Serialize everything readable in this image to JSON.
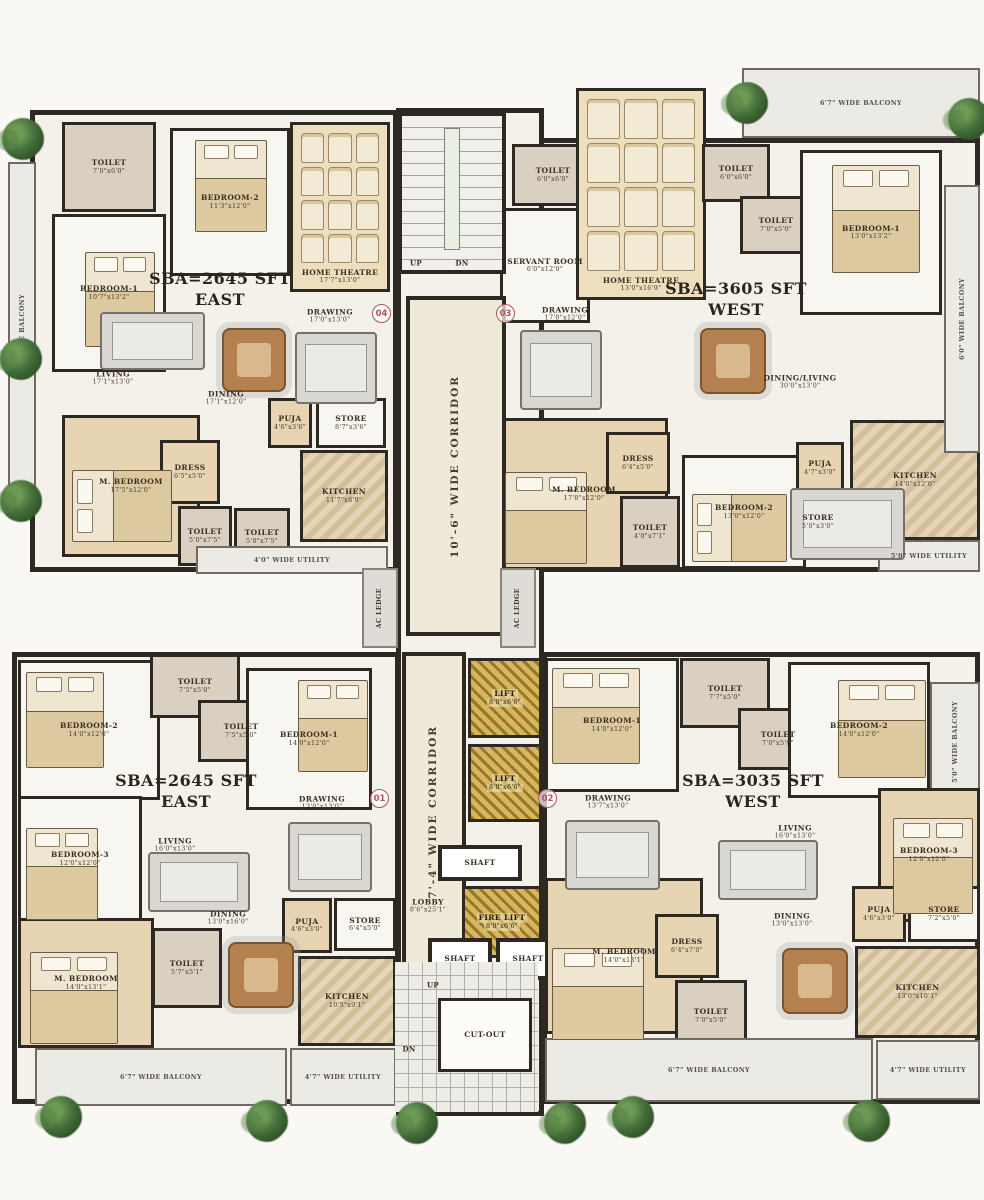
{
  "plan_title": "Residential tower typical floor plan with four units",
  "colors": {
    "wall": "#2e2823",
    "slab": "#f3f1ea",
    "tan_room": "#e6d4b2",
    "toilet": "#d9d0c2",
    "theatre": "#eddfbd",
    "corridor": "#efe9da",
    "lift_gold": "#c8a23c",
    "balcony": "#eceae5",
    "tree_green": "#47703c",
    "unit_badge_red": "#b05454",
    "text": "#3c2f23"
  },
  "units": [
    {
      "id": "unit-top-left",
      "line1": "SBA=2645 SFT",
      "line2": "EAST",
      "x": 220,
      "y": 290
    },
    {
      "id": "unit-top-right",
      "line1": "SBA=3605 SFT",
      "line2": "WEST",
      "x": 736,
      "y": 300
    },
    {
      "id": "unit-bottom-left",
      "line1": "SBA=2645 SFT",
      "line2": "EAST",
      "x": 186,
      "y": 792
    },
    {
      "id": "unit-bottom-right",
      "line1": "SBA=3035 SFT",
      "line2": "WEST",
      "x": 753,
      "y": 792
    }
  ],
  "unit_badges": [
    {
      "n": "04",
      "x": 372,
      "y": 304
    },
    {
      "n": "03",
      "x": 496,
      "y": 304
    },
    {
      "n": "01",
      "x": 370,
      "y": 789
    },
    {
      "n": "02",
      "x": 538,
      "y": 789
    }
  ],
  "slabs": [
    {
      "x": 30,
      "y": 110,
      "w": 368,
      "h": 462
    },
    {
      "x": 498,
      "y": 138,
      "w": 482,
      "h": 434
    },
    {
      "x": 12,
      "y": 652,
      "w": 388,
      "h": 452
    },
    {
      "x": 542,
      "y": 652,
      "w": 438,
      "h": 452
    },
    {
      "x": 396,
      "y": 108,
      "w": 148,
      "h": 1008
    }
  ],
  "rooms": [
    {
      "id": "tl-toilet-1",
      "label": "TOILET",
      "dims": "7'0\"x6'0\"",
      "x": 62,
      "y": 122,
      "w": 94,
      "h": 90,
      "kind": "toilet"
    },
    {
      "id": "tl-bedroom-2",
      "label": "BEDROOM-2",
      "dims": "11'3\"x12'0\"",
      "x": 170,
      "y": 128,
      "w": 120,
      "h": 148,
      "kind": "room"
    },
    {
      "id": "tl-home-theatre",
      "label": "HOME THEATRE",
      "dims": "17'7\"x13'0\"",
      "x": 290,
      "y": 122,
      "w": 100,
      "h": 170,
      "kind": "theatre"
    },
    {
      "id": "tl-bedroom-1",
      "label": "BEDROOM-1",
      "dims": "10'7\"x13'2\"",
      "x": 52,
      "y": 214,
      "w": 114,
      "h": 158,
      "kind": "room"
    },
    {
      "id": "tl-living",
      "label": "LIVING",
      "dims": "17'1\"x13'0\"",
      "x": 113,
      "y": 378,
      "kind": "open"
    },
    {
      "id": "tl-dining",
      "label": "DINING",
      "dims": "17'1\"x12'0\"",
      "x": 226,
      "y": 398,
      "kind": "open"
    },
    {
      "id": "tl-drawing",
      "label": "DRAWING",
      "dims": "17'0\"x13'0\"",
      "x": 330,
      "y": 316,
      "kind": "open"
    },
    {
      "id": "tl-puja",
      "label": "PUJA",
      "dims": "4'6\"x3'6\"",
      "x": 268,
      "y": 398,
      "w": 44,
      "h": 50,
      "kind": "tan"
    },
    {
      "id": "tl-store",
      "label": "STORE",
      "dims": "8'7\"x3'6\"",
      "x": 316,
      "y": 398,
      "w": 70,
      "h": 50,
      "kind": "room"
    },
    {
      "id": "tl-m-bedroom",
      "label": "M. BEDROOM",
      "dims": "17'5\"x12'0\"",
      "x": 62,
      "y": 415,
      "w": 138,
      "h": 142,
      "kind": "tan"
    },
    {
      "id": "tl-dress",
      "label": "DRESS",
      "dims": "6'5\"x5'0\"",
      "x": 160,
      "y": 440,
      "w": 60,
      "h": 64,
      "kind": "tan"
    },
    {
      "id": "tl-toilet-2",
      "label": "TOILET",
      "dims": "5'0\"x7'5\"",
      "x": 178,
      "y": 506,
      "w": 54,
      "h": 60,
      "kind": "toilet"
    },
    {
      "id": "tl-toilet-3",
      "label": "TOILET",
      "dims": "5'0\"x7'5\"",
      "x": 234,
      "y": 508,
      "w": 56,
      "h": 58,
      "kind": "toilet"
    },
    {
      "id": "tl-kitchen",
      "label": "KITCHEN",
      "dims": "11'7\"x8'9\"",
      "x": 300,
      "y": 450,
      "w": 88,
      "h": 92,
      "kind": "marble"
    },
    {
      "id": "tl-utility",
      "label": "4'0\" WIDE UTILITY",
      "dims": "",
      "x": 196,
      "y": 546,
      "w": 192,
      "h": 28,
      "kind": "balcony"
    },
    {
      "id": "tl-balcony",
      "label": "5'0\" WIDE BALCONY",
      "dims": "",
      "x": 8,
      "y": 162,
      "w": 28,
      "h": 345,
      "kind": "balcony",
      "vert": true
    },
    {
      "id": "tr-balcony-top",
      "label": "6'7\" WIDE BALCONY",
      "dims": "",
      "x": 742,
      "y": 68,
      "w": 238,
      "h": 70,
      "kind": "balcony"
    },
    {
      "id": "tr-toilet-1",
      "label": "TOILET",
      "dims": "6'0\"x6'0\"",
      "x": 512,
      "y": 144,
      "w": 82,
      "h": 62,
      "kind": "toilet"
    },
    {
      "id": "tr-servant-room",
      "label": "SERVANT ROOM",
      "dims": "6'0\"x12'0\"",
      "x": 500,
      "y": 208,
      "w": 90,
      "h": 115,
      "kind": "room"
    },
    {
      "id": "tr-home-theatre",
      "label": "HOME THEATRE",
      "dims": "13'0\"x16'9\"",
      "x": 576,
      "y": 88,
      "w": 130,
      "h": 212,
      "kind": "theatre"
    },
    {
      "id": "tr-toilet-2",
      "label": "TOILET",
      "dims": "6'0\"x6'0\"",
      "x": 702,
      "y": 144,
      "w": 68,
      "h": 58,
      "kind": "toilet"
    },
    {
      "id": "tr-toilet-3",
      "label": "TOILET",
      "dims": "7'0\"x5'0\"",
      "x": 740,
      "y": 196,
      "w": 72,
      "h": 58,
      "kind": "toilet"
    },
    {
      "id": "tr-bedroom-1",
      "label": "BEDROOM-1",
      "dims": "13'0\"x13'2\"",
      "x": 800,
      "y": 150,
      "w": 142,
      "h": 165,
      "kind": "room"
    },
    {
      "id": "tr-drawing",
      "label": "DRAWING",
      "dims": "17'0\"x12'0\"",
      "x": 565,
      "y": 314,
      "kind": "open"
    },
    {
      "id": "tr-dining-living",
      "label": "DINING/LIVING",
      "dims": "30'0\"x13'0\"",
      "x": 800,
      "y": 382,
      "kind": "open"
    },
    {
      "id": "tr-m-bedroom",
      "label": "M. BEDROOM",
      "dims": "17'0\"x12'0\"",
      "x": 500,
      "y": 418,
      "w": 168,
      "h": 152,
      "kind": "tan"
    },
    {
      "id": "tr-dress",
      "label": "DRESS",
      "dims": "6'4\"x5'0\"",
      "x": 606,
      "y": 432,
      "w": 64,
      "h": 62,
      "kind": "tan"
    },
    {
      "id": "tr-toilet-4",
      "label": "TOILET",
      "dims": "4'0\"x7'1\"",
      "x": 620,
      "y": 496,
      "w": 60,
      "h": 72,
      "kind": "toilet"
    },
    {
      "id": "tr-bedroom-2",
      "label": "BEDROOM-2",
      "dims": "13'0\"x12'0\"",
      "x": 682,
      "y": 455,
      "w": 124,
      "h": 114,
      "kind": "room"
    },
    {
      "id": "tr-puja",
      "label": "PUJA",
      "dims": "4'7\"x3'0\"",
      "x": 796,
      "y": 442,
      "w": 48,
      "h": 52,
      "kind": "tan"
    },
    {
      "id": "tr-store",
      "label": "STORE",
      "dims": "5'0\"x3'0\"",
      "x": 792,
      "y": 498,
      "w": 52,
      "h": 48,
      "kind": "room"
    },
    {
      "id": "tr-kitchen",
      "label": "KITCHEN",
      "dims": "14'0\"x12'0\"",
      "x": 850,
      "y": 420,
      "w": 130,
      "h": 120,
      "kind": "marble"
    },
    {
      "id": "tr-utility",
      "label": "5'0\" WIDE UTILITY",
      "dims": "",
      "x": 878,
      "y": 540,
      "w": 102,
      "h": 32,
      "kind": "balcony"
    },
    {
      "id": "tr-balcony-right",
      "label": "6'0\" WIDE BALCONY",
      "dims": "",
      "x": 944,
      "y": 185,
      "w": 36,
      "h": 268,
      "kind": "balcony",
      "vert": true
    },
    {
      "id": "core-stairs-top",
      "label": "",
      "dims": "",
      "x": 398,
      "y": 112,
      "w": 108,
      "h": 162,
      "kind": "stairs"
    },
    {
      "id": "core-up-top",
      "label": "UP",
      "dims": "",
      "x": 416,
      "y": 264,
      "kind": "tiny"
    },
    {
      "id": "core-dn-top",
      "label": "DN",
      "dims": "",
      "x": 462,
      "y": 264,
      "kind": "tiny"
    },
    {
      "id": "core-corridor-top",
      "label": "10'-6\" WIDE CORRIDOR",
      "dims": "",
      "x": 406,
      "y": 296,
      "w": 100,
      "h": 340,
      "kind": "corridor",
      "vert": true
    },
    {
      "id": "core-ac-ledge-left",
      "label": "AC LEDGE",
      "dims": "",
      "x": 362,
      "y": 568,
      "w": 36,
      "h": 80,
      "kind": "ledge",
      "vert": true
    },
    {
      "id": "core-ac-ledge-right",
      "label": "AC LEDGE",
      "dims": "",
      "x": 500,
      "y": 568,
      "w": 36,
      "h": 80,
      "kind": "ledge",
      "vert": true
    },
    {
      "id": "core-corridor-bottom",
      "label": "7'-4\" WIDE CORRIDOR",
      "dims": "",
      "x": 402,
      "y": 652,
      "w": 64,
      "h": 320,
      "kind": "corridor",
      "vert": true
    },
    {
      "id": "core-lift-1",
      "label": "LIFT",
      "dims": "8'0\"x6'6\"",
      "x": 468,
      "y": 658,
      "w": 74,
      "h": 80,
      "kind": "gold"
    },
    {
      "id": "core-lift-2",
      "label": "LIFT",
      "dims": "8'0\"x6'6\"",
      "x": 468,
      "y": 744,
      "w": 74,
      "h": 78,
      "kind": "gold"
    },
    {
      "id": "core-shaft-1",
      "label": "SHAFT",
      "dims": "",
      "x": 438,
      "y": 845,
      "w": 84,
      "h": 36,
      "kind": "shaft"
    },
    {
      "id": "core-fire-lift",
      "label": "FIRE LIFT",
      "dims": "8'0\"x6'6\"",
      "x": 462,
      "y": 886,
      "w": 80,
      "h": 72,
      "kind": "gold"
    },
    {
      "id": "core-lobby",
      "label": "LOBBY",
      "dims": "8'6\"x25'1\"",
      "x": 428,
      "y": 906,
      "kind": "open"
    },
    {
      "id": "core-shaft-2",
      "label": "SHAFT",
      "dims": "",
      "x": 428,
      "y": 938,
      "w": 64,
      "h": 42,
      "kind": "shaft"
    },
    {
      "id": "core-shaft-3",
      "label": "SHAFT",
      "dims": "",
      "x": 496,
      "y": 938,
      "w": 64,
      "h": 42,
      "kind": "shaft"
    },
    {
      "id": "core-stairs-bottom",
      "label": "",
      "dims": "",
      "x": 395,
      "y": 962,
      "w": 143,
      "h": 150,
      "kind": "stairs2"
    },
    {
      "id": "core-cut-out",
      "label": "CUT-OUT",
      "dims": "",
      "x": 438,
      "y": 998,
      "w": 94,
      "h": 74,
      "kind": "cutout"
    },
    {
      "id": "core-up-bottom",
      "label": "UP",
      "dims": "",
      "x": 433,
      "y": 986,
      "kind": "tiny"
    },
    {
      "id": "core-dn-bottom",
      "label": "DN",
      "dims": "",
      "x": 409,
      "y": 1050,
      "kind": "tiny"
    },
    {
      "id": "bl-bedroom-2",
      "label": "BEDROOM-2",
      "dims": "14'0\"x12'0\"",
      "x": 18,
      "y": 660,
      "w": 142,
      "h": 140,
      "kind": "room"
    },
    {
      "id": "bl-toilet-1",
      "label": "TOILET",
      "dims": "7'5\"x5'0\"",
      "x": 150,
      "y": 654,
      "w": 90,
      "h": 64,
      "kind": "toilet"
    },
    {
      "id": "bl-toilet-2",
      "label": "TOILET",
      "dims": "7'5\"x5'0\"",
      "x": 198,
      "y": 700,
      "w": 86,
      "h": 62,
      "kind": "toilet"
    },
    {
      "id": "bl-bedroom-1",
      "label": "BEDROOM-1",
      "dims": "14'0\"x12'0\"",
      "x": 246,
      "y": 668,
      "w": 126,
      "h": 142,
      "kind": "room"
    },
    {
      "id": "bl-bedroom-3",
      "label": "BEDROOM-3",
      "dims": "12'0\"x12'0\"",
      "x": 18,
      "y": 796,
      "w": 124,
      "h": 126,
      "kind": "room"
    },
    {
      "id": "bl-living",
      "label": "LIVING",
      "dims": "16'0\"x13'0\"",
      "x": 175,
      "y": 845,
      "kind": "open"
    },
    {
      "id": "bl-drawing",
      "label": "DRAWING",
      "dims": "13'0\"x13'0\"",
      "x": 322,
      "y": 803,
      "kind": "open"
    },
    {
      "id": "bl-m-bedroom",
      "label": "M. BEDROOM",
      "dims": "14'0\"x13'1\"",
      "x": 18,
      "y": 918,
      "w": 136,
      "h": 130,
      "kind": "tan"
    },
    {
      "id": "bl-toilet-3",
      "label": "TOILET",
      "dims": "5'7\"x5'1\"",
      "x": 152,
      "y": 928,
      "w": 70,
      "h": 80,
      "kind": "toilet"
    },
    {
      "id": "bl-dining",
      "label": "DINING",
      "dims": "13'0\"x16'0\"",
      "x": 228,
      "y": 918,
      "kind": "open"
    },
    {
      "id": "bl-puja",
      "label": "PUJA",
      "dims": "4'6\"x3'0\"",
      "x": 282,
      "y": 898,
      "w": 50,
      "h": 55,
      "kind": "tan"
    },
    {
      "id": "bl-store",
      "label": "STORE",
      "dims": "6'4\"x5'0\"",
      "x": 334,
      "y": 898,
      "w": 62,
      "h": 53,
      "kind": "room"
    },
    {
      "id": "bl-kitchen",
      "label": "KITCHEN",
      "dims": "10'5\"x9'1\"",
      "x": 298,
      "y": 956,
      "w": 98,
      "h": 90,
      "kind": "marble"
    },
    {
      "id": "bl-balcony",
      "label": "6'7\" WIDE BALCONY",
      "dims": "",
      "x": 35,
      "y": 1048,
      "w": 252,
      "h": 58,
      "kind": "balcony"
    },
    {
      "id": "bl-utility",
      "label": "4'7\" WIDE UTILITY",
      "dims": "",
      "x": 290,
      "y": 1048,
      "w": 106,
      "h": 58,
      "kind": "balcony"
    },
    {
      "id": "br-bedroom-1",
      "label": "BEDROOM-1",
      "dims": "14'0\"x12'0\"",
      "x": 545,
      "y": 658,
      "w": 134,
      "h": 134,
      "kind": "room"
    },
    {
      "id": "br-toilet-1",
      "label": "TOILET",
      "dims": "7'7\"x5'0\"",
      "x": 680,
      "y": 658,
      "w": 90,
      "h": 70,
      "kind": "toilet"
    },
    {
      "id": "br-toilet-2",
      "label": "TOILET",
      "dims": "7'0\"x5'0\"",
      "x": 738,
      "y": 708,
      "w": 80,
      "h": 62,
      "kind": "toilet"
    },
    {
      "id": "br-bedroom-2",
      "label": "BEDROOM-2",
      "dims": "14'0\"x12'0\"",
      "x": 788,
      "y": 662,
      "w": 142,
      "h": 136,
      "kind": "room"
    },
    {
      "id": "br-balcony-corner",
      "label": "5'0\" WIDE BALCONY",
      "dims": "",
      "x": 930,
      "y": 682,
      "w": 50,
      "h": 120,
      "kind": "balcony",
      "vert": true
    },
    {
      "id": "br-drawing",
      "label": "DRAWING",
      "dims": "13'7\"x13'0\"",
      "x": 608,
      "y": 802,
      "kind": "open"
    },
    {
      "id": "br-living",
      "label": "LIVING",
      "dims": "16'0\"x13'0\"",
      "x": 795,
      "y": 832,
      "kind": "open"
    },
    {
      "id": "br-bedroom-3",
      "label": "BEDROOM-3",
      "dims": "12'0\"x12'0\"",
      "x": 878,
      "y": 788,
      "w": 102,
      "h": 134,
      "kind": "tan"
    },
    {
      "id": "br-m-bedroom",
      "label": "M. BEDROOM",
      "dims": "14'0\"x13'1\"",
      "x": 545,
      "y": 878,
      "w": 158,
      "h": 156,
      "kind": "tan"
    },
    {
      "id": "br-dress",
      "label": "DRESS",
      "dims": "6'4\"x7'0\"",
      "x": 655,
      "y": 914,
      "w": 64,
      "h": 64,
      "kind": "tan"
    },
    {
      "id": "br-toilet-3",
      "label": "TOILET",
      "dims": "7'0\"x5'0\"",
      "x": 675,
      "y": 980,
      "w": 72,
      "h": 72,
      "kind": "toilet"
    },
    {
      "id": "br-dining",
      "label": "DINING",
      "dims": "13'0\"x13'0\"",
      "x": 792,
      "y": 920,
      "kind": "open"
    },
    {
      "id": "br-puja",
      "label": "PUJA",
      "dims": "4'6\"x3'0\"",
      "x": 852,
      "y": 886,
      "w": 54,
      "h": 56,
      "kind": "tan"
    },
    {
      "id": "br-store",
      "label": "STORE",
      "dims": "7'2\"x5'0\"",
      "x": 908,
      "y": 886,
      "w": 72,
      "h": 56,
      "kind": "room"
    },
    {
      "id": "br-kitchen",
      "label": "KITCHEN",
      "dims": "13'0\"x10'1\"",
      "x": 855,
      "y": 946,
      "w": 125,
      "h": 92,
      "kind": "marble"
    },
    {
      "id": "br-balcony",
      "label": "6'7\" WIDE BALCONY",
      "dims": "",
      "x": 545,
      "y": 1038,
      "w": 328,
      "h": 64,
      "kind": "balcony"
    },
    {
      "id": "br-utility",
      "label": "4'7\" WIDE UTILITY",
      "dims": "",
      "x": 876,
      "y": 1040,
      "w": 104,
      "h": 60,
      "kind": "balcony"
    }
  ],
  "furniture": {
    "beds": [
      {
        "x": 195,
        "y": 140,
        "w": 72,
        "h": 92
      },
      {
        "x": 85,
        "y": 252,
        "w": 70,
        "h": 95
      },
      {
        "x": 72,
        "y": 470,
        "w": 100,
        "h": 72,
        "o": "h"
      },
      {
        "x": 832,
        "y": 165,
        "w": 88,
        "h": 108
      },
      {
        "x": 505,
        "y": 472,
        "w": 82,
        "h": 92
      },
      {
        "x": 692,
        "y": 494,
        "w": 95,
        "h": 68,
        "o": "h"
      },
      {
        "x": 26,
        "y": 672,
        "w": 78,
        "h": 96
      },
      {
        "x": 298,
        "y": 680,
        "w": 70,
        "h": 92
      },
      {
        "x": 26,
        "y": 828,
        "w": 72,
        "h": 92
      },
      {
        "x": 30,
        "y": 952,
        "w": 88,
        "h": 92
      },
      {
        "x": 552,
        "y": 668,
        "w": 88,
        "h": 96
      },
      {
        "x": 838,
        "y": 680,
        "w": 88,
        "h": 98
      },
      {
        "x": 893,
        "y": 818,
        "w": 80,
        "h": 96
      },
      {
        "x": 552,
        "y": 948,
        "w": 92,
        "h": 92
      }
    ],
    "tables": [
      {
        "x": 222,
        "y": 328,
        "w": 64,
        "h": 64
      },
      {
        "x": 700,
        "y": 328,
        "w": 66,
        "h": 66
      },
      {
        "x": 228,
        "y": 942,
        "w": 66,
        "h": 66
      },
      {
        "x": 782,
        "y": 948,
        "w": 66,
        "h": 66
      }
    ],
    "sofas": [
      {
        "x": 100,
        "y": 312,
        "w": 105,
        "h": 58
      },
      {
        "x": 295,
        "y": 332,
        "w": 82,
        "h": 72
      },
      {
        "x": 520,
        "y": 330,
        "w": 82,
        "h": 80
      },
      {
        "x": 790,
        "y": 488,
        "w": 115,
        "h": 72
      },
      {
        "x": 148,
        "y": 852,
        "w": 102,
        "h": 60
      },
      {
        "x": 288,
        "y": 822,
        "w": 84,
        "h": 70
      },
      {
        "x": 565,
        "y": 820,
        "w": 95,
        "h": 70
      },
      {
        "x": 718,
        "y": 840,
        "w": 100,
        "h": 60
      }
    ]
  },
  "trees": [
    {
      "x": 2,
      "y": 118
    },
    {
      "x": 0,
      "y": 338
    },
    {
      "x": 0,
      "y": 480
    },
    {
      "x": 726,
      "y": 82
    },
    {
      "x": 948,
      "y": 98
    },
    {
      "x": 40,
      "y": 1096
    },
    {
      "x": 246,
      "y": 1100
    },
    {
      "x": 396,
      "y": 1102
    },
    {
      "x": 544,
      "y": 1102
    },
    {
      "x": 612,
      "y": 1096
    },
    {
      "x": 848,
      "y": 1100
    }
  ]
}
